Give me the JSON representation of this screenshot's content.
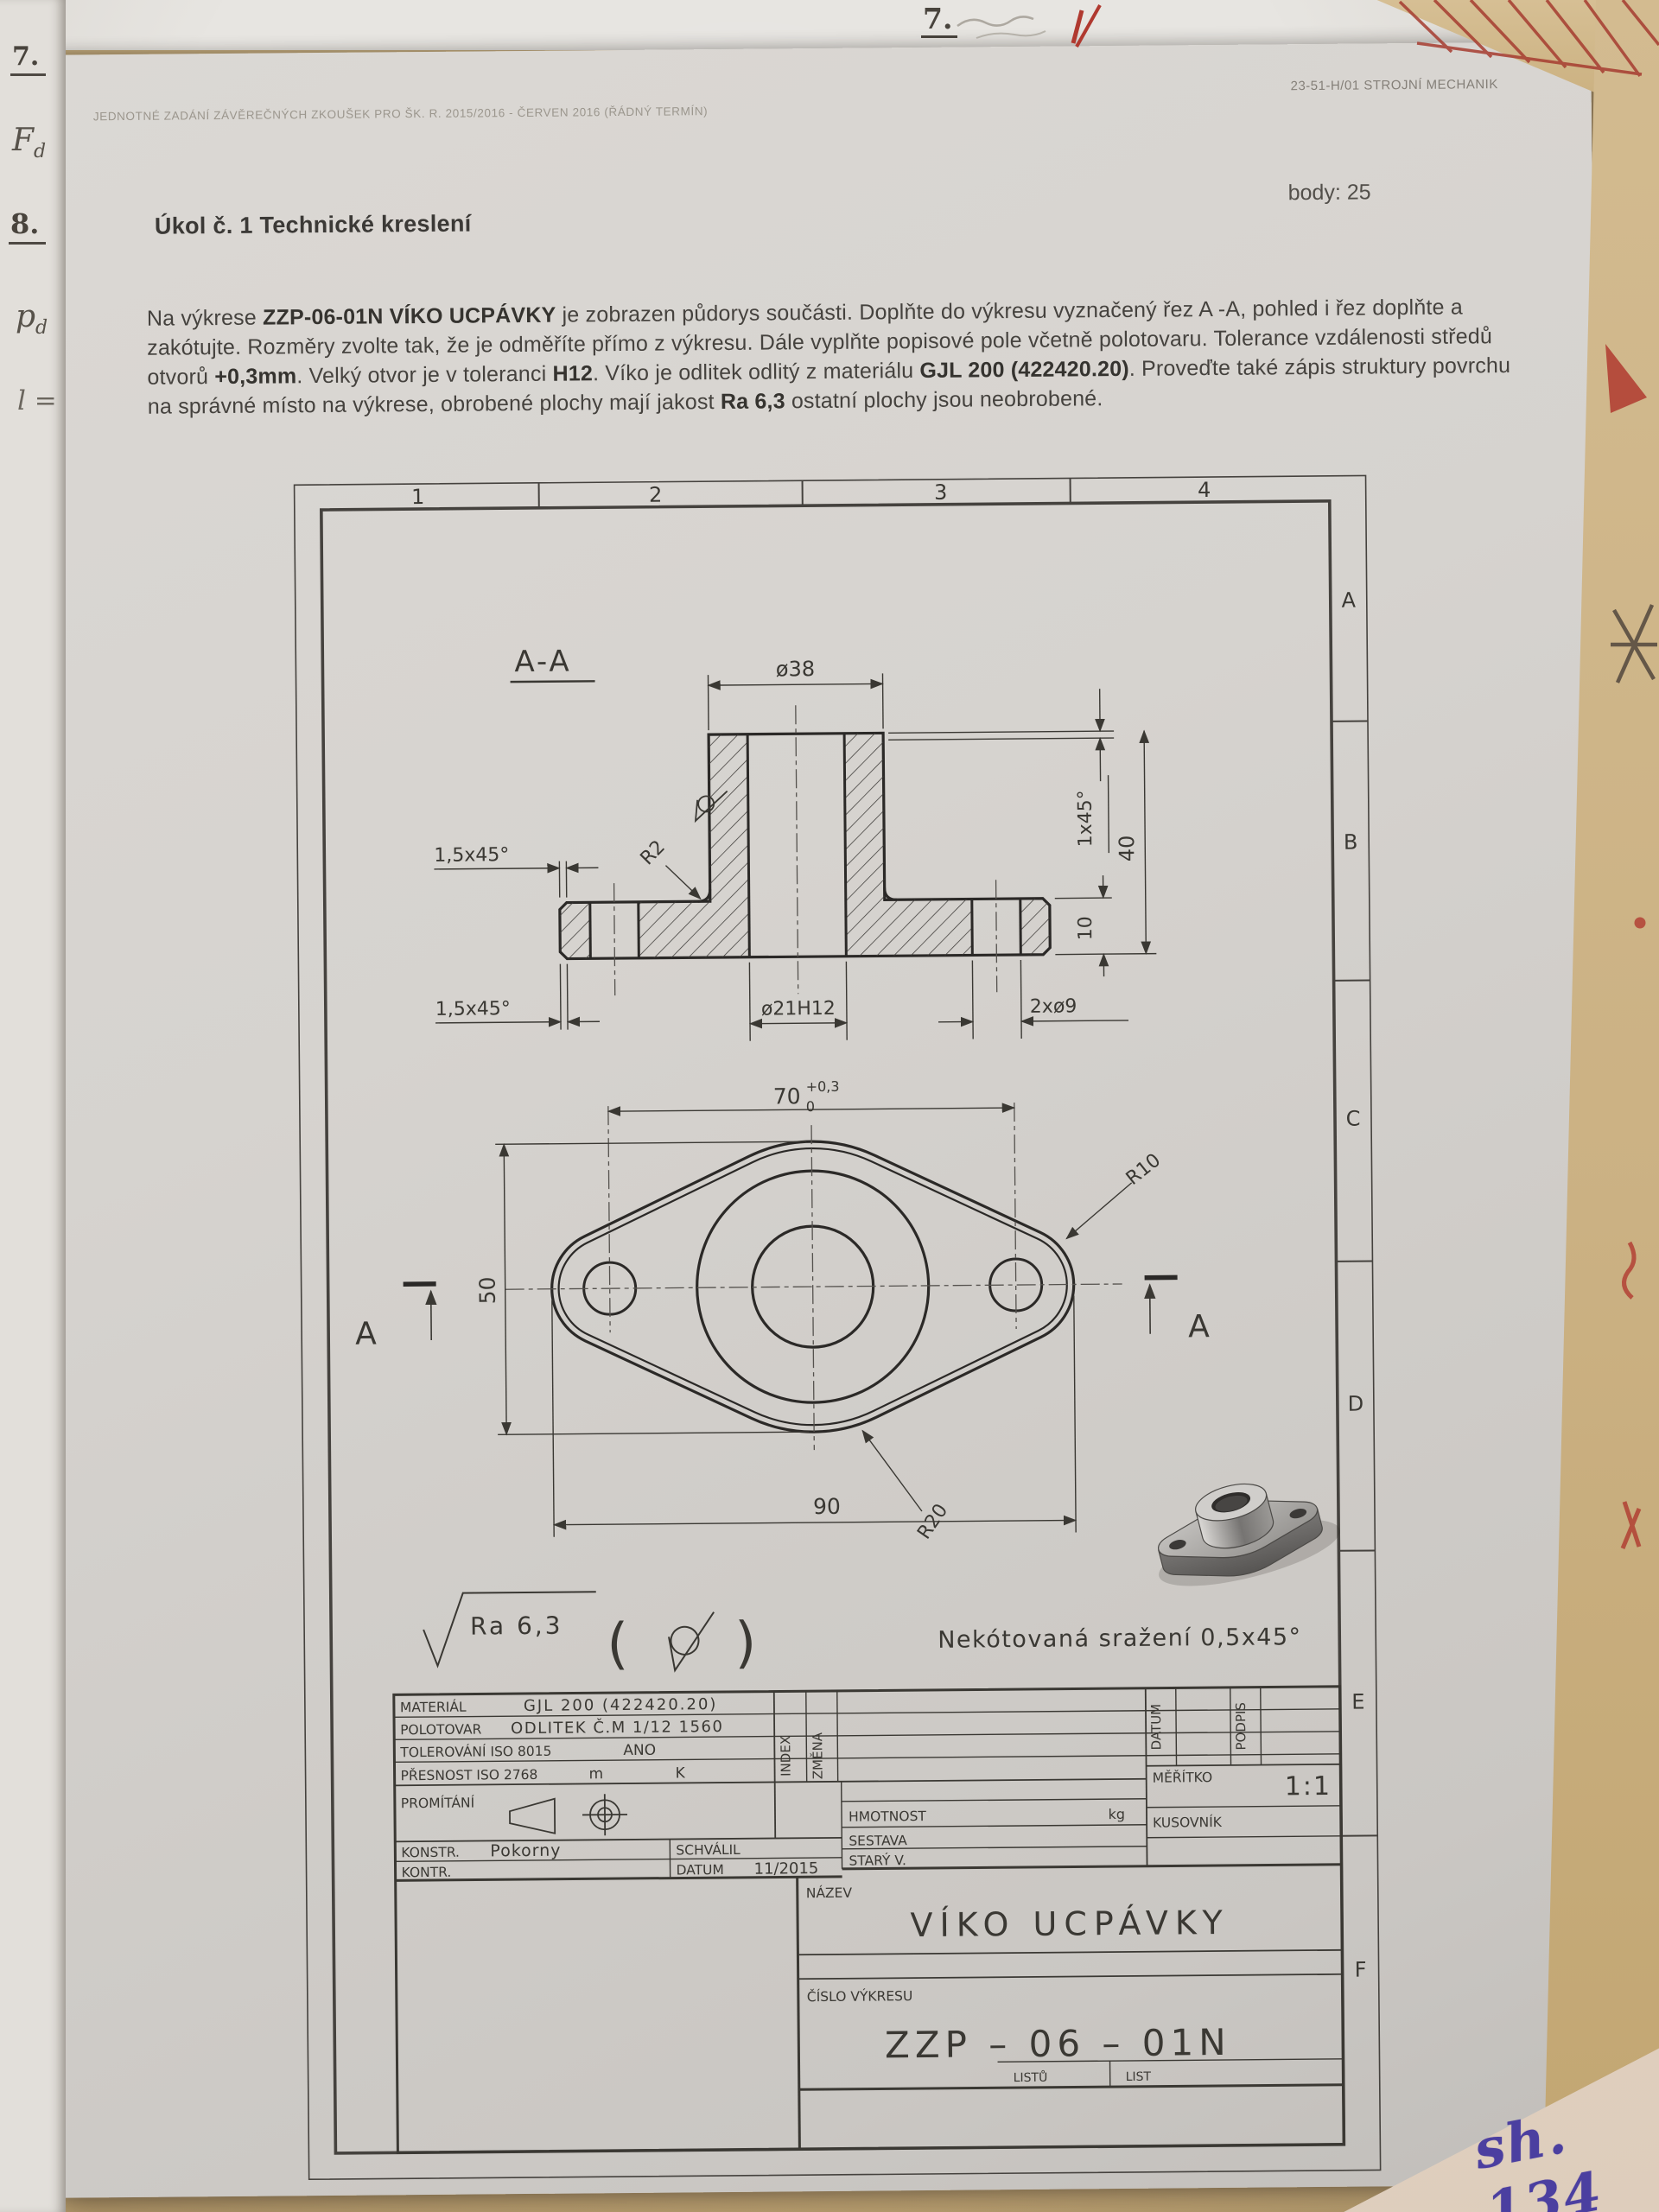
{
  "page": {
    "header_left": "JEDNOTNÉ ZADÁNÍ ZÁVĚREČNÝCH ZKOUŠEK PRO ŠK. R. 2015/2016 - ČERVEN 2016 (ŘÁDNÝ TERMÍN)",
    "header_right": "23-51-H/01 STROJNÍ MECHANIK",
    "points": "body: 25",
    "task_title": "Úkol č. 1 Technické kreslení"
  },
  "task": {
    "segments": [
      "Na výkrese ",
      "ZZP-06-01N VÍKO UCPÁVKY",
      " je zobrazen půdorys součásti. Doplňte do výkresu vyznačený řez A -A, pohled i řez doplňte a zakótujte. Rozměry zvolte tak, že je odměříte přímo z výkresu. Dále vyplňte popisové pole včetně polotovaru. Tolerance vzdálenosti středů otvorů ",
      "+0,3mm",
      ". Velký otvor je v toleranci ",
      "H12",
      ". Víko je odlitek odlitý z materiálu ",
      "GJL 200 (422420.20)",
      ". Proveďte také zápis struktury povrchu na správné místo na výkrese, obrobené plochy mají jakost ",
      "Ra 6,3",
      " ostatní plochy jsou neobrobené."
    ]
  },
  "drawing": {
    "section_label": "A-A",
    "dims": {
      "d38": "ø38",
      "chamfer_top": "1,5x45°",
      "chamfer_bottom": "1,5x45°",
      "chamfer_hub": "1x45°",
      "h40": "40",
      "h10": "10",
      "r2": "R2",
      "bore": "ø21H12",
      "holes": "2xø9",
      "pitch": "70",
      "pitch_tol_up": "+0,3",
      "pitch_tol_dn": "0",
      "w50": "50",
      "l90": "90",
      "r10": "R10",
      "r20": "R20",
      "cut_left": "A",
      "cut_right": "A"
    },
    "surface_note": "Ra 6,3",
    "chamfer_note": "Nekótovaná sražení 0,5x45°",
    "border_cols": [
      "1",
      "2",
      "3",
      "4"
    ],
    "border_rows": [
      "A",
      "B",
      "C",
      "D",
      "E",
      "F"
    ]
  },
  "title_block": {
    "material_label": "MATERIÁL",
    "material_value": "GJL 200 (422420.20)",
    "polotovar_label": "POLOTOVAR",
    "polotovar_value": "ODLITEK Č.M 1/12 1560",
    "tolerovani_label": "TOLEROVÁNÍ ISO 8015",
    "tolerovani_value": "ANO",
    "presnost_label": "PŘESNOST ISO 2768",
    "presnost_m": "m",
    "presnost_k": "K",
    "promitani_label": "PROMÍTÁNÍ",
    "index_col": "INDEX",
    "zmena_col": "ZMĚNA",
    "datum_col": "DATUM",
    "podpis_col": "PODPIS",
    "konstr_label": "KONSTR.",
    "konstr_value": "Pokorny",
    "kontr_label": "KONTR.",
    "schvalil_label": "SCHVÁLIL",
    "datum_label": "DATUM",
    "datum_value": "11/2015",
    "hmotnost_label": "HMOTNOST",
    "hmotnost_unit": "kg",
    "sestava_label": "SESTAVA",
    "stary_label": "STARÝ V.",
    "meritko_label": "MĚŘÍTKO",
    "meritko_value": "1:1",
    "kusovnik_label": "KUSOVNÍK",
    "nazev_label": "NÁZEV",
    "nazev_value": "VÍKO UCPÁVKY",
    "cislo_label": "ČÍSLO VÝKRESU",
    "cislo_value": "ZZP – 06 – 01N",
    "listu_label": "LISTŮ",
    "list_label": "LIST"
  },
  "annotations": {
    "top_note": "7.",
    "margin_item1": "7.",
    "margin_f": "F",
    "margin_f_sub": "d",
    "margin_item2": "8.",
    "margin_p": "p",
    "margin_p_sub": "d",
    "margin_l": "l =",
    "bottom_right_note": "sh. 134"
  },
  "colors": {
    "paper": "#d6d3cf",
    "tan_paper": "#cbb183",
    "pink_paper": "#e8dbcd",
    "ink": "#3a3833",
    "faded_ink": "#9b968d",
    "red_mark": "#b0392f",
    "purple_ink": "#4b3fa0"
  }
}
